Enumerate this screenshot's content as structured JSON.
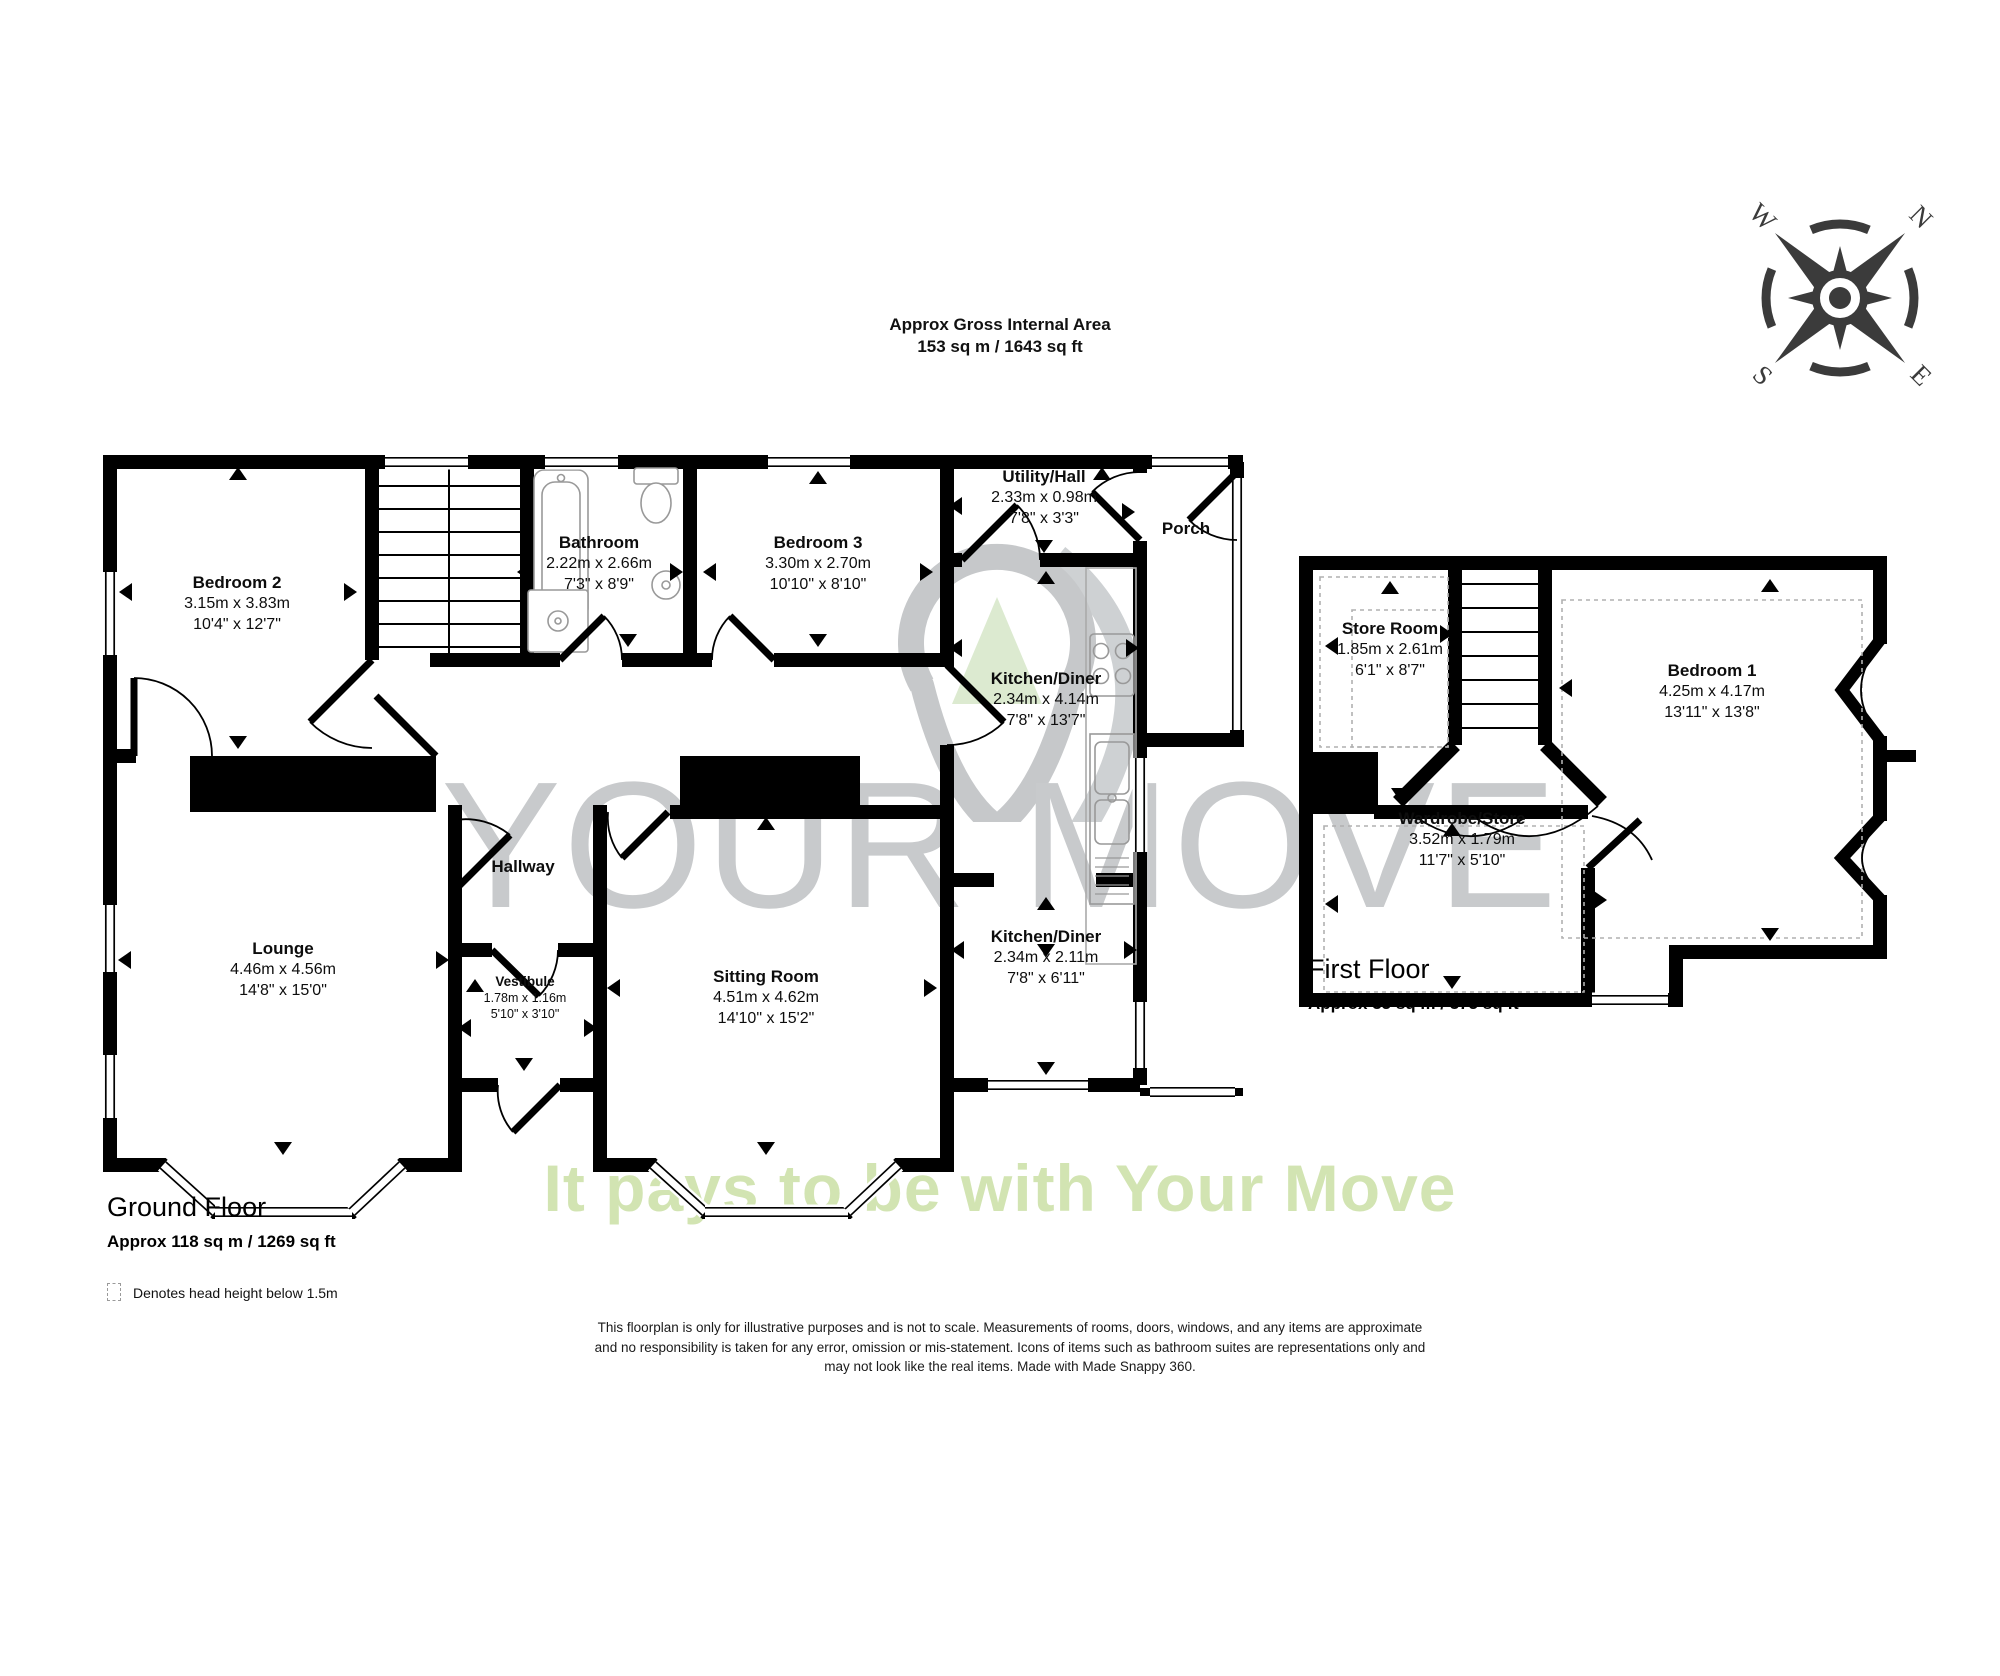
{
  "header": {
    "title": "Approx Gross Internal Area",
    "area": "153 sq m / 1643 sq ft"
  },
  "watermark": {
    "brand": "YOUR MOVE",
    "tagline": "It pays to be with Your Move"
  },
  "compass": {
    "north": "N",
    "east": "E",
    "south": "S",
    "west": "W"
  },
  "floors": {
    "ground": {
      "title": "Ground Floor",
      "area": "Approx 118 sq m / 1269 sq ft"
    },
    "first": {
      "title": "First Floor",
      "area": "Approx 35 sq m / 375 sq ft"
    }
  },
  "legend": {
    "head_height": "Denotes head height below 1.5m"
  },
  "rooms": {
    "bedroom2": {
      "name": "Bedroom 2",
      "metric": "3.15m x 3.83m",
      "imperial": "10'4\" x 12'7\""
    },
    "bathroom": {
      "name": "Bathroom",
      "metric": "2.22m x 2.66m",
      "imperial": "7'3\" x 8'9\""
    },
    "bedroom3": {
      "name": "Bedroom 3",
      "metric": "3.30m x 2.70m",
      "imperial": "10'10\" x 8'10\""
    },
    "utility_hall": {
      "name": "Utility/Hall",
      "metric": "2.33m x 0.98m",
      "imperial": "7'8\" x 3'3\""
    },
    "porch": {
      "name": "Porch"
    },
    "kitchen_upper": {
      "name": "Kitchen/Diner",
      "metric": "2.34m x 4.14m",
      "imperial": "7'8\" x 13'7\""
    },
    "kitchen_lower": {
      "name": "Kitchen/Diner",
      "metric": "2.34m x 2.11m",
      "imperial": "7'8\" x 6'11\""
    },
    "lounge": {
      "name": "Lounge",
      "metric": "4.46m x 4.56m",
      "imperial": "14'8\" x 15'0\""
    },
    "hallway": {
      "name": "Hallway"
    },
    "vestibule": {
      "name": "Vestibule",
      "metric": "1.78m x 1.16m",
      "imperial": "5'10\" x 3'10\""
    },
    "sitting_room": {
      "name": "Sitting Room",
      "metric": "4.51m x 4.62m",
      "imperial": "14'10\" x 15'2\""
    },
    "store_room": {
      "name": "Store Room",
      "metric": "1.85m x 2.61m",
      "imperial": "6'1\" x 8'7\""
    },
    "bedroom1": {
      "name": "Bedroom 1",
      "metric": "4.25m x 4.17m",
      "imperial": "13'11\" x 13'8\""
    },
    "wardrobe_store": {
      "name": "Wardrobe/Store",
      "metric": "3.52m x 1.79m",
      "imperial": "11'7\" x 5'10\""
    }
  },
  "disclaimer": {
    "line1": "This floorplan is only for illustrative purposes and is not to scale. Measurements of rooms, doors, windows, and any items are approximate",
    "line2": "and no responsibility is taken for any error, omission or mis-statement. Icons of items such as bathroom suites are representations only and",
    "line3": "may not look like the real items. Made with Made Snappy 360."
  },
  "colors": {
    "wall": "#000000",
    "fixture": "#999999",
    "head_height_dash": "#b0b0b0",
    "compass": "#3b3b3b",
    "watermark_gray": "#c8cacc",
    "watermark_green": "#d2e4b2"
  }
}
